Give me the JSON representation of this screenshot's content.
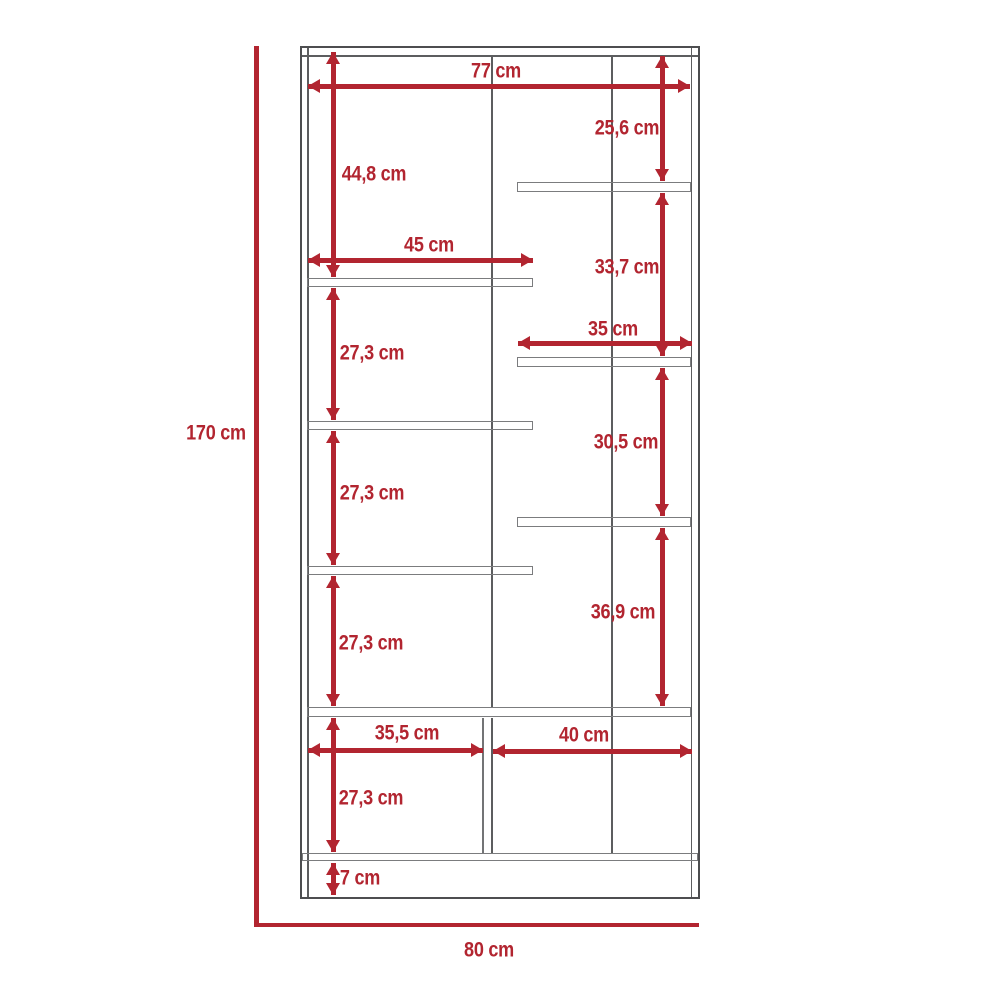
{
  "diagram": {
    "type": "furniture-dimension-drawing",
    "unit": "cm",
    "accent_color": "#b22530",
    "line_color": "#5c5d5f"
  },
  "dims": {
    "total_height": "170 cm",
    "total_width": "80 cm",
    "top_width": "77 cm",
    "upper_left_height": "44,8 cm",
    "upper_right_height": "25,6 cm",
    "left_shelf_width": "45 cm",
    "right_gap_1": "33,7 cm",
    "right_shelf_width": "35 cm",
    "left_gap_1": "27,3 cm",
    "right_gap_2": "30,5 cm",
    "left_gap_2": "27,3 cm",
    "right_gap_3": "36,9 cm",
    "left_gap_3": "27,3 cm",
    "bottom_left_width": "35,5 cm",
    "bottom_right_width": "40 cm",
    "bottom_left_height": "27,3 cm",
    "base_height": "7 cm"
  }
}
